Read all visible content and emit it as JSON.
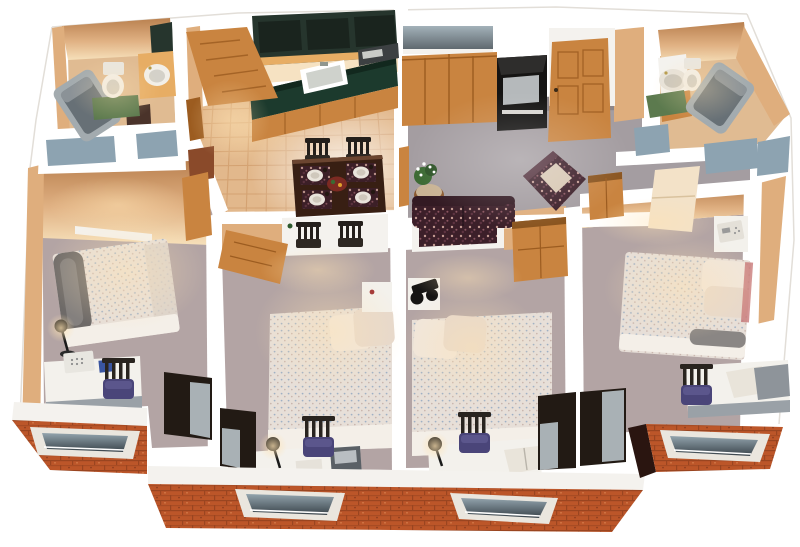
{
  "meta": {
    "title": "3D cutaway floor plan — four-bedroom two-bath apartment, bird's-eye render",
    "view": "isometric dollhouse cutaway, white cut walls, brick exterior at front"
  },
  "palette": {
    "bg": "#ffffff",
    "wall_white": "#ffffff",
    "band_white": "#f4f2ee",
    "wall_face": "#dfae7d",
    "wall_face_dark": "#b07545",
    "wall_face_light": "#f6e2c2",
    "carpet_bedroom": "#b3a4a4",
    "carpet_living": "#a49da1",
    "tile": "#e2b88c",
    "tile_grout": "#c8905e",
    "bath_floor": "#e0bb92",
    "brick": "#bc5629",
    "brick_dark": "#93401c",
    "wood": "#c98440",
    "wood_dark": "#9c5c20",
    "wood_light": "#e7ad64",
    "counter_green": "#1c3a2d",
    "cabinet_top": "#26352d",
    "appliance_black": "#151413",
    "appliance_screen": "#b5b9bb",
    "desk_top": "#f3f1ec",
    "desk_side": "#9aa1a7",
    "chair_cushion": "#4a4579",
    "chair_frame": "#29241f",
    "table_wood": "#381f13",
    "bath_mat": "#5c7a4e",
    "tub_gray": "#a3abaf",
    "tub_dark": "#677076",
    "closet_dark": "#221a14",
    "closet_door": "#a9b1b5",
    "glass_panel": "#8da3b1",
    "window_frame": "#eae6de",
    "window_glass_dark": "#39434a",
    "window_glass_light": "#93a4ad",
    "sofa_floral": "#3e2029",
    "bed_spread": "#e7dfd8",
    "pillow": "#f0e6dc",
    "placemat_red": "#6e1d17",
    "plant_green": "#3c6a33",
    "lamp_glow": "#ffe3b3"
  },
  "rooms": [
    {
      "name": "bathroom-1",
      "position": "top-left",
      "furniture": [
        "bathtub",
        "toilet",
        "vanity-sink",
        "green-bath-mat",
        "medicine-cabinet"
      ]
    },
    {
      "name": "entry-hall",
      "position": "top-left-center",
      "furniture": [
        "open-entry-door",
        "side-door",
        "tile-floor"
      ]
    },
    {
      "name": "kitchen",
      "position": "top-center",
      "furniture": [
        "upper-cabinets",
        "green-counter-with-sink",
        "microwave",
        "lower-cabinets",
        "tile-floor"
      ]
    },
    {
      "name": "dining-area",
      "position": "center",
      "furniture": [
        "dark-wood-table",
        "four-place-settings",
        "centerpiece",
        "four-chairs"
      ]
    },
    {
      "name": "living-room",
      "position": "top-right-center",
      "furniture": [
        "window",
        "sliding-closet-doors",
        "tv-cabinet",
        "front-door",
        "floral-sofa",
        "floral-armchair",
        "plant-on-round-table",
        "gray-carpet"
      ]
    },
    {
      "name": "bathroom-2",
      "position": "top-right",
      "furniture": [
        "vanity-sink",
        "toilet",
        "green-bath-mat",
        "bathtub"
      ]
    },
    {
      "name": "bedroom-1",
      "position": "left",
      "furniture": [
        "double-bed-with-bolster",
        "floor-lamp",
        "desk-with-phone",
        "desk-chair",
        "closet",
        "brick-window"
      ]
    },
    {
      "name": "bedroom-2",
      "position": "center-left",
      "furniture": [
        "bed",
        "nightstand",
        "desk",
        "desk-lamp",
        "desk-chair",
        "pass-through-niche-with-chairs",
        "open-door",
        "closet",
        "brick-window"
      ]
    },
    {
      "name": "bedroom-3",
      "position": "center-right",
      "furniture": [
        "bed",
        "nightstand-with-stereo",
        "wood-dresser",
        "desk-with-book",
        "desk-lamp",
        "desk-chair",
        "pass-through-niche",
        "closet",
        "brick-window"
      ]
    },
    {
      "name": "bedroom-4",
      "position": "right",
      "furniture": [
        "bed",
        "nightstand-with-phone",
        "wood-armoire",
        "open-white-door",
        "desk-with-books",
        "desk-chair",
        "closet",
        "brick-window",
        "side-window"
      ]
    }
  ],
  "exterior": {
    "brick_sections": 3,
    "brick_windows": 4,
    "interior_glass_panels": 6
  },
  "counts": {
    "bedrooms": 4,
    "bathrooms": 2,
    "dining_chairs": 4,
    "desk_chairs": 4,
    "beds": 4
  }
}
